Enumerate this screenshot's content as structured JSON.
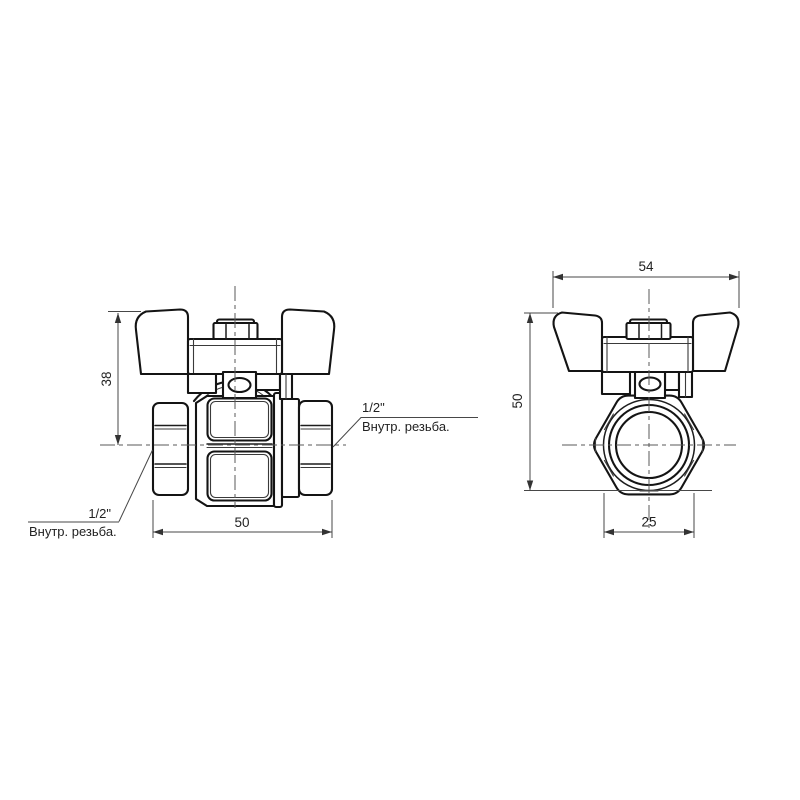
{
  "drawing": {
    "type": "technical-drawing-ball-valve-butterfly-handle",
    "background_color": "#ffffff",
    "line_color": "#141414",
    "side_view": {
      "dim_height": "38",
      "dim_length": "50",
      "thread_size_left": "1/2\"",
      "thread_note_left": "Внутр. резьба.",
      "thread_size_right": "1/2\"",
      "thread_note_right": "Внутр. резьба."
    },
    "front_view": {
      "dim_width": "54",
      "dim_height": "50",
      "dim_across_flats": "25"
    }
  }
}
